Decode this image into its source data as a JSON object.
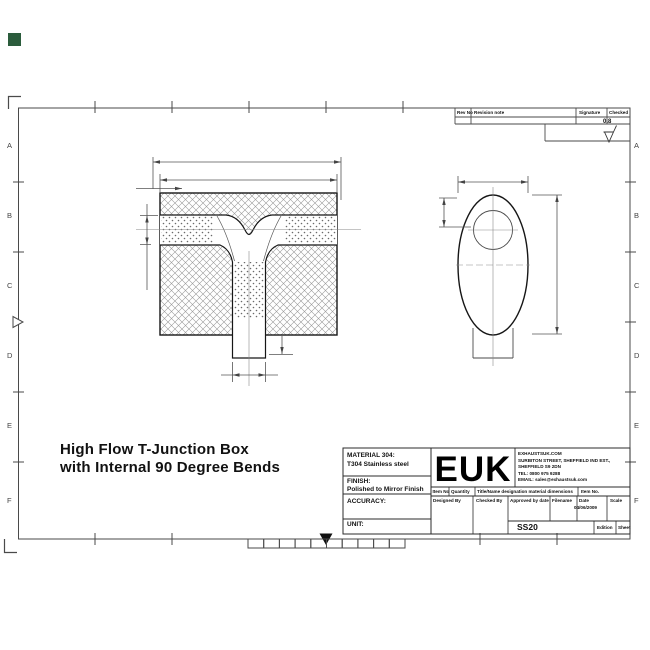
{
  "sheet": {
    "green_marker_color": "#2b5c3c"
  },
  "drawing_title": {
    "line1": "High Flow T-Junction Box",
    "line2": "with Internal 90 Degree Bends"
  },
  "frame": {
    "row_labels": [
      "A",
      "B",
      "C",
      "D",
      "E",
      "F"
    ]
  },
  "revision_table": {
    "col_rev_no": "Rev No",
    "col_revision_note": "Revision note",
    "col_signature": "Signature",
    "col_checked": "Checked",
    "surface_finish": "0.8"
  },
  "title_block": {
    "material_label": "MATERIAL 304:",
    "material_value": "T304 Stainless steel",
    "finish_label": "FINISH:",
    "finish_value": "Polished to Mirror Finish",
    "accuracy_label": "ACCURACY:",
    "unit_label": "UNIT:",
    "logo": "EUK",
    "company": {
      "website": "EXHAUSTSUK.COM",
      "address1": "SURBITON STREET, SHEFFIELD IND EST.,",
      "address2": "SHEFFIELD S9 2DN",
      "tel": "TEL: 0800 975 9288",
      "email": "EMAIL: sales@exhaustsuk.com"
    },
    "item_row": {
      "item_no": "Item No",
      "quantity": "Quantity",
      "title_name": "Title/Name designation material dimensions",
      "item_no2": "Item No."
    },
    "sign_row": {
      "designed": "Designed By",
      "checked": "Checked By",
      "approved": "Approved by date",
      "filename": "Filename",
      "date": "Date",
      "scale": "Scale"
    },
    "date_value": "04/06/2009",
    "drawing_number": "SS20",
    "edition_label": "Edition",
    "sheet_label": "Sheet"
  }
}
